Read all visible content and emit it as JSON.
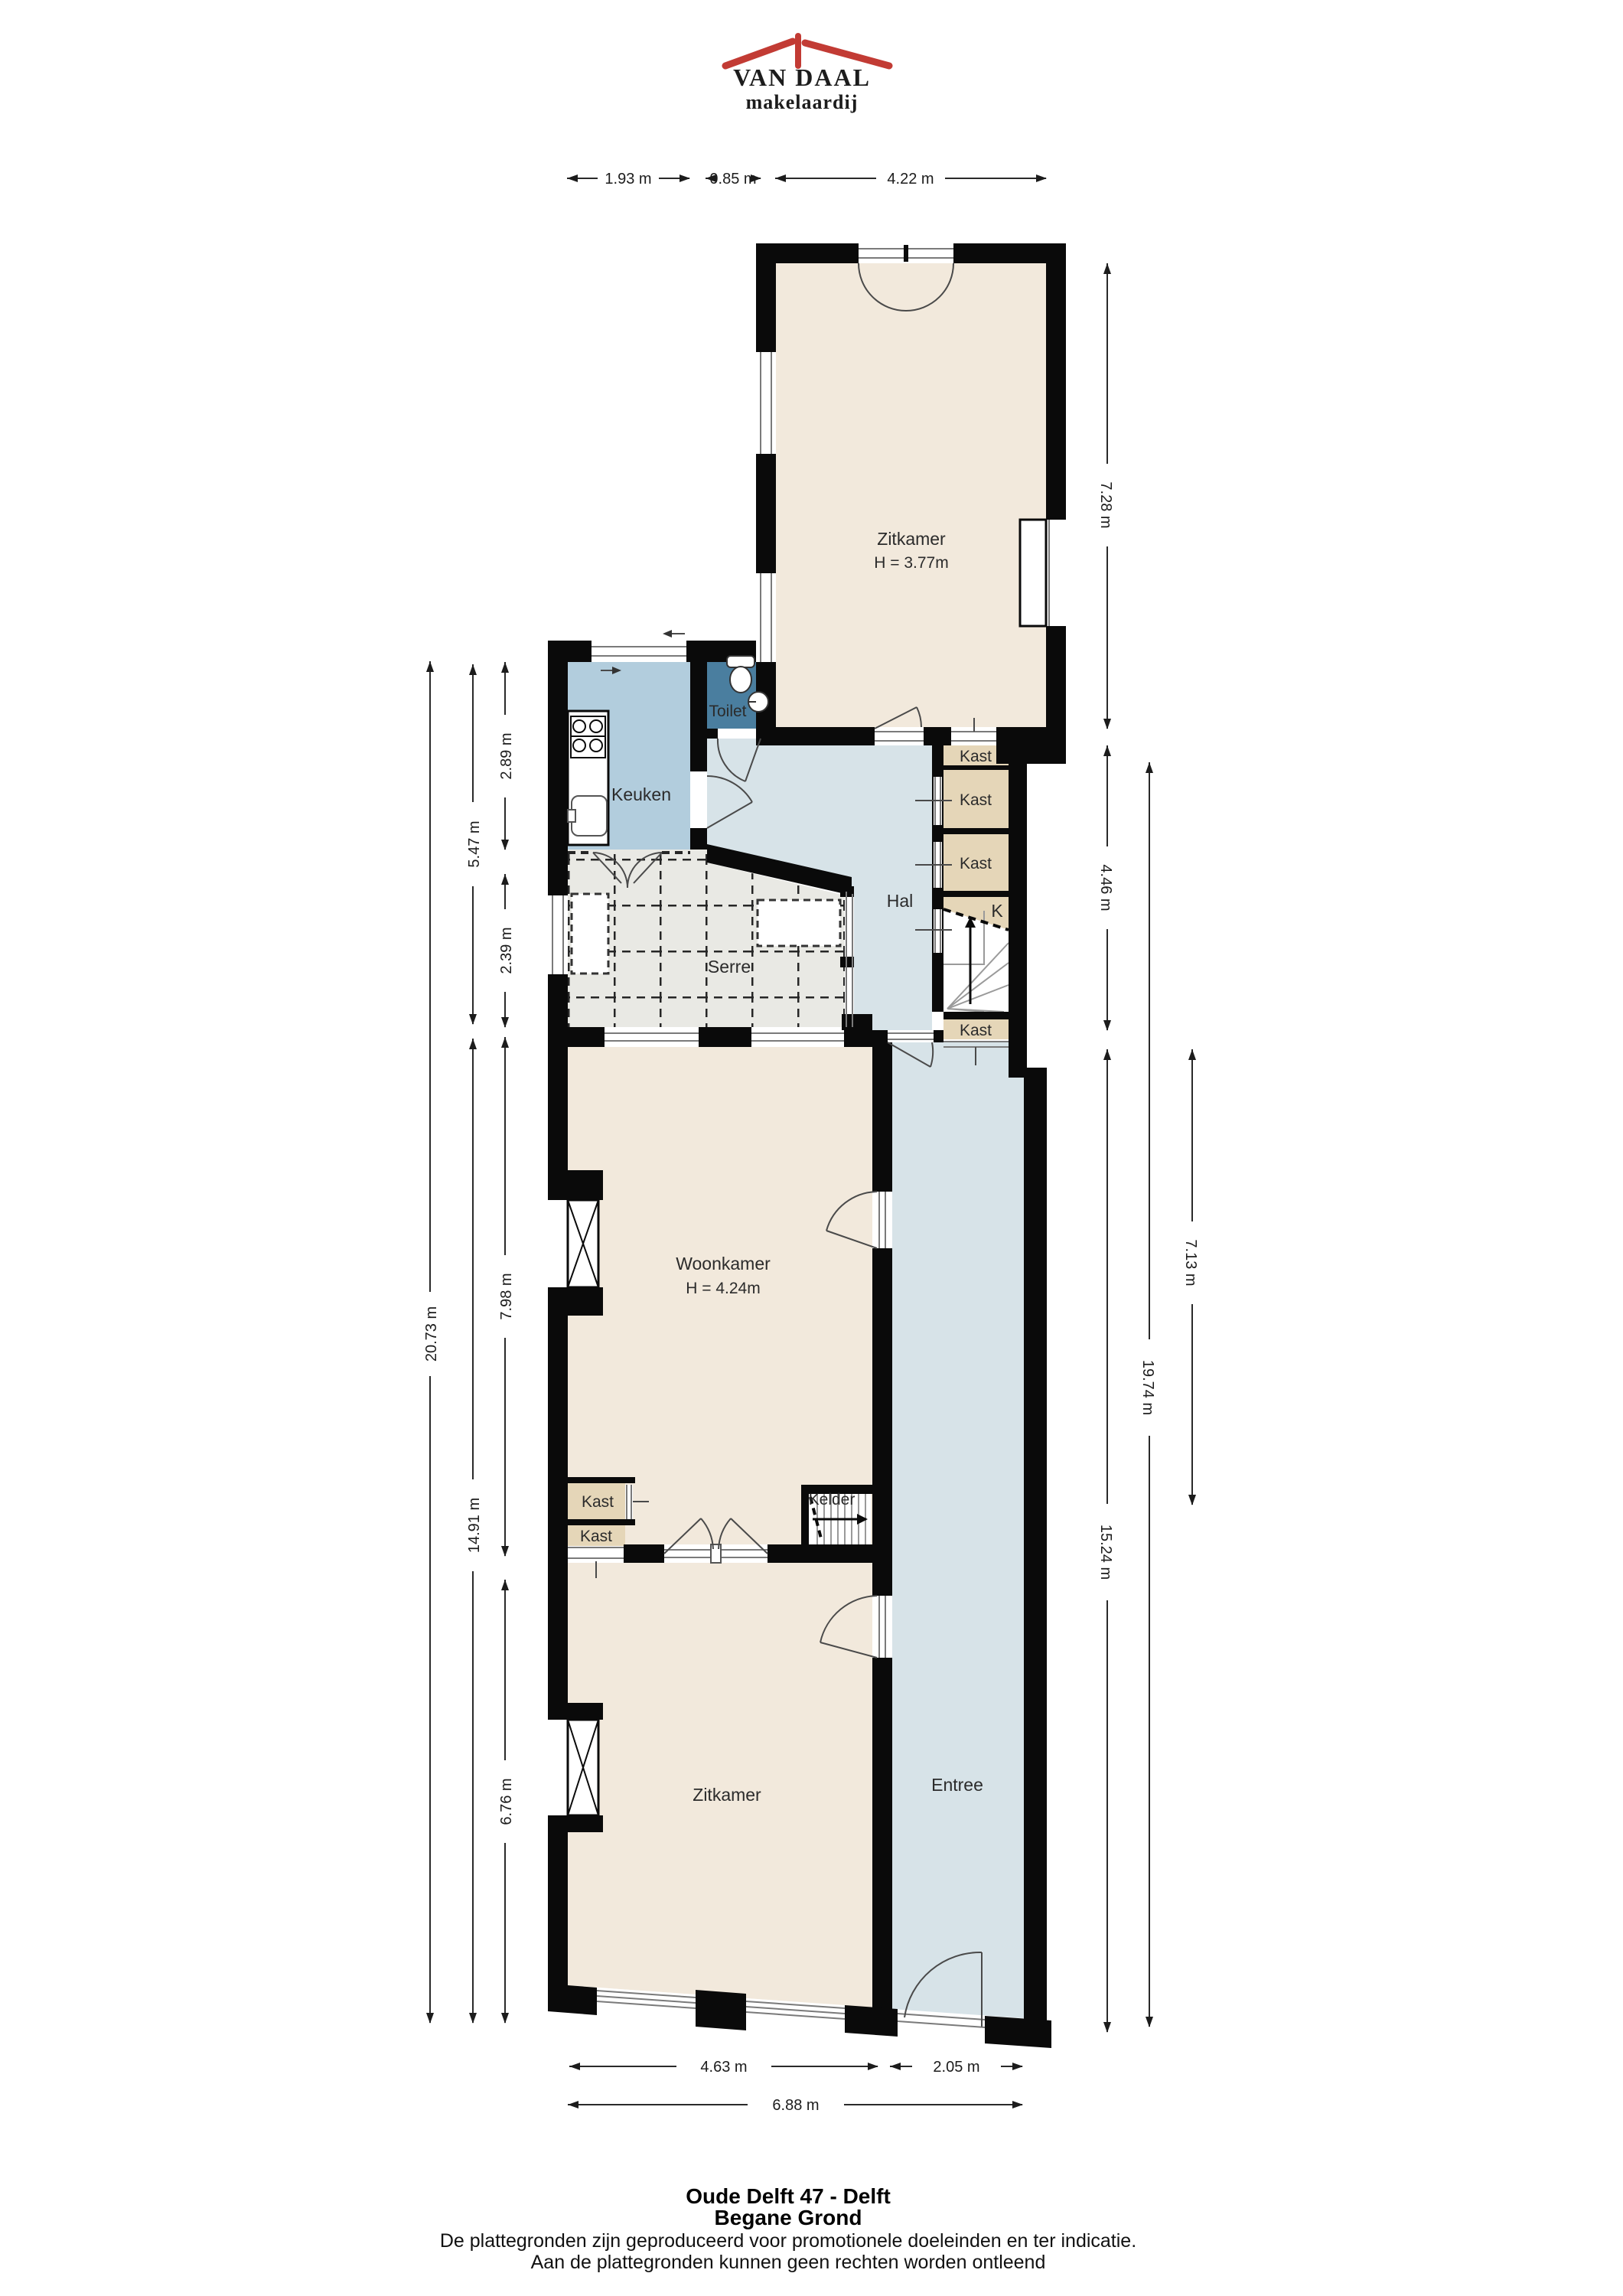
{
  "logo": {
    "name": "VAN DAAL",
    "tagline": "makelaardij"
  },
  "footer": {
    "address": "Oude Delft 47 - Delft",
    "floor": "Begane Grond",
    "disclaimer1": "De plattegronden zijn geproduceerd voor promotionele doeleinden en ter indicatie.",
    "disclaimer2": "Aan de plattegronden kunnen geen rechten worden ontleend"
  },
  "rooms": {
    "zitkamer_boven": {
      "label": "Zitkamer",
      "ceiling": "H = 3.77m"
    },
    "keuken": {
      "label": "Keuken"
    },
    "toilet": {
      "label": "Toilet"
    },
    "hal": {
      "label": "Hal"
    },
    "serre": {
      "label": "Serre"
    },
    "woonkamer": {
      "label": "Woonkamer",
      "ceiling": "H = 4.24m"
    },
    "kelder": {
      "label": "Kelder"
    },
    "zitkamer_beneden": {
      "label": "Zitkamer"
    },
    "entree": {
      "label": "Entree"
    },
    "kast": {
      "label": "Kast"
    },
    "trapkast": {
      "label": "K"
    }
  },
  "dimensions": {
    "top": [
      "1.93 m",
      "0.85 m",
      "4.22 m"
    ],
    "left": {
      "total": "20.73 m",
      "upper_section": "5.47 m",
      "lower_section": "14.91 m",
      "keuken": "2.89 m",
      "serre": "2.39 m",
      "woonkamer": "7.98 m",
      "zitkamer": "6.76 m"
    },
    "right": {
      "zitkamer_boven": "7.28 m",
      "hal": "4.46 m",
      "entree": "15.24 m",
      "total": "19.74 m",
      "woonkamer": "7.13 m"
    },
    "bottom": {
      "zitkamer": "4.63 m",
      "entree": "2.05 m",
      "total": "6.88 m"
    }
  },
  "colors": {
    "wall": "#0a0a0a",
    "room_cream": "#f2e9dc",
    "kitchen_blue": "#b2cddd",
    "toilet_teal": "#4a7e9f",
    "hall_blue": "#d7e3e8",
    "closet_beige": "#e5d6b8",
    "serre_grey": "#e9e9e4",
    "logo_navy": "#2b4a8c",
    "logo_red": "#c23b34"
  }
}
